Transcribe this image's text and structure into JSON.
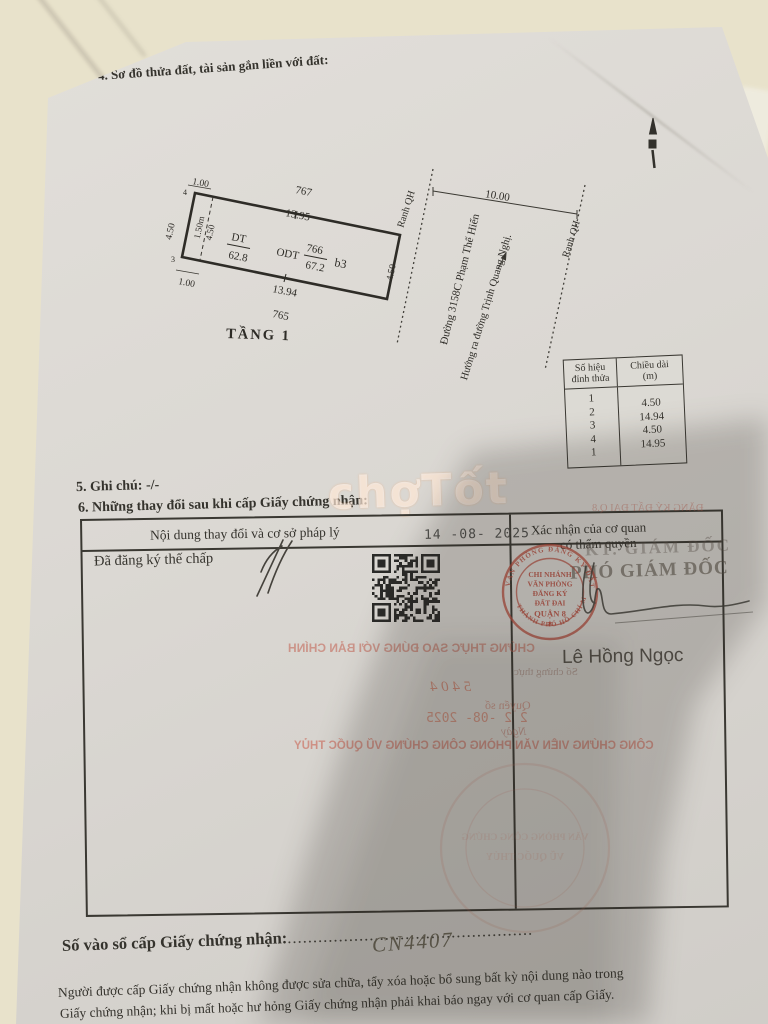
{
  "page": {
    "section4_title": "4. Sơ đồ thửa đất, tài sản gắn liền với đất:",
    "section5_note": "5. Ghi chú: -/-",
    "section6_title": "6. Những thay đổi sau khi cấp Giấy chứng nhận:",
    "registry_label": "Số vào sổ cấp Giấy chứng nhận:",
    "registry_dots_left": "....................................",
    "registry_number": "CN4407",
    "registry_dots_right": "............",
    "footer_line1": "Người được cấp Giấy chứng nhận không được sửa chữa, tẩy xóa hoặc bổ sung bất kỳ nội dung nào trong",
    "footer_line2": "Giấy chứng nhận; khi bị mất hoặc hư hỏng Giấy chứng nhận phải khai báo ngay với cơ quan cấp Giấy."
  },
  "diagram": {
    "floor_label": "TẦNG 1",
    "adjacent_top": "767",
    "adjacent_bottom": "765",
    "len_top": "13.95",
    "len_bottom": "13.94",
    "len_left": "4.50",
    "len_right": "4.50",
    "offset_top_left": "1.00",
    "offset_bottom_left": "1.00",
    "inner_width": "1.50m",
    "inner_height": "4.50",
    "vertex_4": "4",
    "vertex_3": "3",
    "dt_label": "DT",
    "dt_value": "62.8",
    "odt_label": "ODT",
    "odt_parcel": "766",
    "odt_value": "67.2",
    "zone_label": "b3",
    "qh_label_1": "Ranh QH",
    "qh_label_2": "Ranh QH",
    "qh_width": "10.00",
    "road_1": "Đường 3158C Phạm Thế Hiển",
    "road_2": "Hướng ra đường Trịnh Quang Nghị.",
    "vertex_table": {
      "col1_header": [
        "Số hiệu",
        "đỉnh thửa"
      ],
      "col2_header": [
        "Chiều dài",
        "(m)"
      ],
      "vertices": [
        "1",
        "2",
        "3",
        "4",
        "1"
      ],
      "lengths": [
        "4.50",
        "14.94",
        "4.50",
        "14.95"
      ]
    }
  },
  "changes_table": {
    "col1_header": "Nội dung thay đổi và cơ sở pháp lý",
    "col2_header_line1": "Xác nhận của cơ quan",
    "col2_header_line2": "có thẩm quyền",
    "date_stamp": "14 -08- 2025",
    "entry": "Đã đăng ký thế chấp",
    "approver_title_1": "KT. GIÁM ĐỐC",
    "approver_title_2": "PHÓ GIÁM ĐỐC",
    "approver_name": "Lê Hồng Ngọc",
    "stamp": {
      "ring_top": "VĂN PHÒNG ĐĂNG KÝ ĐẤT ĐAI",
      "ring_bottom": "THÀNH PHỐ HỒ CHÍ MINH",
      "center_lines": [
        "CHI NHÁNH",
        "VĂN PHÒNG",
        "ĐĂNG KÝ",
        "ĐẤT ĐAI",
        "QUẬN 8"
      ],
      "star": "★"
    }
  },
  "bleedthrough": {
    "header_fragment": "ĐĂNG KÝ ĐẤT ĐAI Q.8",
    "certify": "CHỨNG THỰC SAO ĐÚNG VỚI BẢN CHÍNH",
    "cert_no_label": "Số chứng thực",
    "handwritten_no": "5 4 0 4",
    "book_label": "Quyển số",
    "date_stamp": "2 2 -08- 2025",
    "date_label": "Ngày",
    "notary": "CÔNG CHỨNG VIÊN VĂN PHÒNG CÔNG CHỨNG VŨ QUỐC THỦY",
    "notary_stamp_line1": "VĂN PHÒNG CÔNG CHỨNG",
    "notary_stamp_line2": "VŨ QUỐC THỦY"
  },
  "watermark": "chợTốt",
  "colors": {
    "stamp_red": "#b4483a",
    "bleed_red": "#c05f4e",
    "ink": "#35332d",
    "paper": "#dbd8d3",
    "surface": "#e8e2cb"
  }
}
